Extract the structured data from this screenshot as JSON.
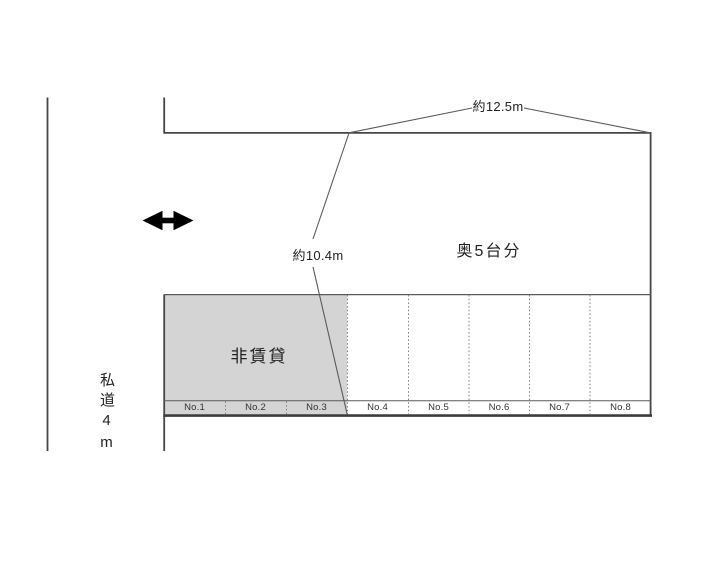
{
  "dimensions": {
    "width_label": "約12.5m",
    "depth_label": "約10.4m"
  },
  "labels": {
    "back_capacity": "奥5台分",
    "non_rental": "非賃貸",
    "private_road": "私道4m"
  },
  "parking_spaces": [
    "No.1",
    "No.2",
    "No.3",
    "No.4",
    "No.5",
    "No.6",
    "No.7",
    "No.8"
  ],
  "icons": {
    "two_way_arrow": "↔"
  },
  "colors": {
    "non_rental_fill": "#d4d4d4",
    "boundary_line": "#464646",
    "thin_line": "#5a5a5a",
    "dotted_line": "#808080",
    "arrow": "#000000"
  }
}
